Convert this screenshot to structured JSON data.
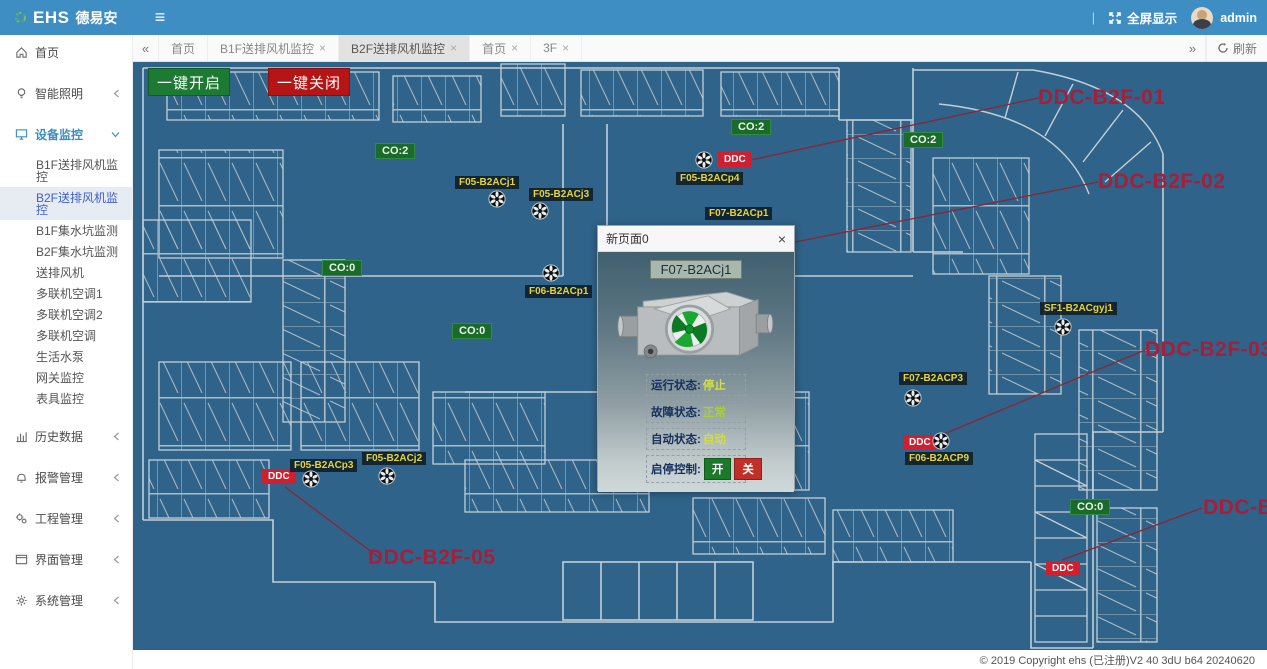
{
  "header": {
    "brand_en": "EHS",
    "brand_cn": "德易安",
    "menu_icon": "≡",
    "divider": "|",
    "fullscreen_label": "全屏显示",
    "username": "admin"
  },
  "sidebar": {
    "items": [
      {
        "label": "首页",
        "icon": "home-icon"
      },
      {
        "label": "智能照明",
        "icon": "bulb-icon"
      },
      {
        "label": "设备监控",
        "icon": "device-icon"
      },
      {
        "label": "历史数据",
        "icon": "chart-icon"
      },
      {
        "label": "报警管理",
        "icon": "bell-icon"
      },
      {
        "label": "工程管理",
        "icon": "gears-icon"
      },
      {
        "label": "界面管理",
        "icon": "window-icon"
      },
      {
        "label": "系统管理",
        "icon": "gear-icon"
      }
    ],
    "submenu": [
      "B1F送排风机监控",
      "B2F送排风机监控",
      "B1F集水坑监测",
      "B2F集水坑监测",
      "送排风机",
      "多联机空调1",
      "多联机空调2",
      "多联机空调",
      "生活水泵",
      "网关监控",
      "表具监控"
    ],
    "active_submenu": "B2F送排风机监控"
  },
  "tabs": {
    "collapse_left": "«",
    "collapse_right": "»",
    "close_glyph": "×",
    "refresh_label": "刷新",
    "items": [
      {
        "label": "首页",
        "closable": false,
        "active": false
      },
      {
        "label": "B1F送排风机监控",
        "closable": true,
        "active": false
      },
      {
        "label": "B2F送排风机监控",
        "closable": true,
        "active": true
      },
      {
        "label": "首页",
        "closable": true,
        "active": false
      },
      {
        "label": "3F",
        "closable": true,
        "active": false
      }
    ]
  },
  "toolbar": {
    "open_all": "一键开启",
    "close_all": "一键关闭"
  },
  "map": {
    "ddc_label": "DDC",
    "co_labels": [
      {
        "text": "CO:2"
      },
      {
        "text": "CO:2"
      },
      {
        "text": "CO:2"
      },
      {
        "text": "CO:0"
      },
      {
        "text": "CO:0"
      },
      {
        "text": "CO:0"
      }
    ],
    "equipment": [
      {
        "name": "F05-B2ACj1"
      },
      {
        "name": "F05-B2ACj3"
      },
      {
        "name": "F05-B2ACp4"
      },
      {
        "name": "F07-B2ACp1"
      },
      {
        "name": "F06-B2ACp1"
      },
      {
        "name": "SF1-B2ACgyj1"
      },
      {
        "name": "F07-B2ACP3"
      },
      {
        "name": "F06-B2ACP9"
      },
      {
        "name": "F05-B2ACp3"
      },
      {
        "name": "F05-B2ACj2"
      }
    ],
    "callouts": [
      {
        "text": "DDC-B2F-01"
      },
      {
        "text": "DDC-B2F-02"
      },
      {
        "text": "DDC-B2F-03"
      },
      {
        "text": "DDC-B2F-05"
      },
      {
        "text": "DDC-B2F-04"
      }
    ]
  },
  "dialog": {
    "title": "新页面0",
    "close_glyph": "×",
    "device_name": "F07-B2ACj1",
    "rows": [
      {
        "label": "运行状态:",
        "value": "停止"
      },
      {
        "label": "故障状态:",
        "value": "正常"
      },
      {
        "label": "自动状态:",
        "value": "自动"
      }
    ],
    "control": {
      "label": "启停控制:",
      "on": "开",
      "off": "关"
    }
  },
  "footer": {
    "copyright": "© 2019 Copyright ehs (已注册)V2 40 3dU b64 20240620"
  },
  "colors": {
    "header_blue": "#3e8ec4",
    "map_background": "#306389",
    "button_green": "#1d7a33",
    "button_red": "#b51515",
    "co_green": "#1a6b2a",
    "ddc_red": "#d01f2f",
    "equip_label_yellow": "#e6d33c",
    "callout_red": "#a81e38",
    "status_value_yellow": "#d3df3d"
  }
}
